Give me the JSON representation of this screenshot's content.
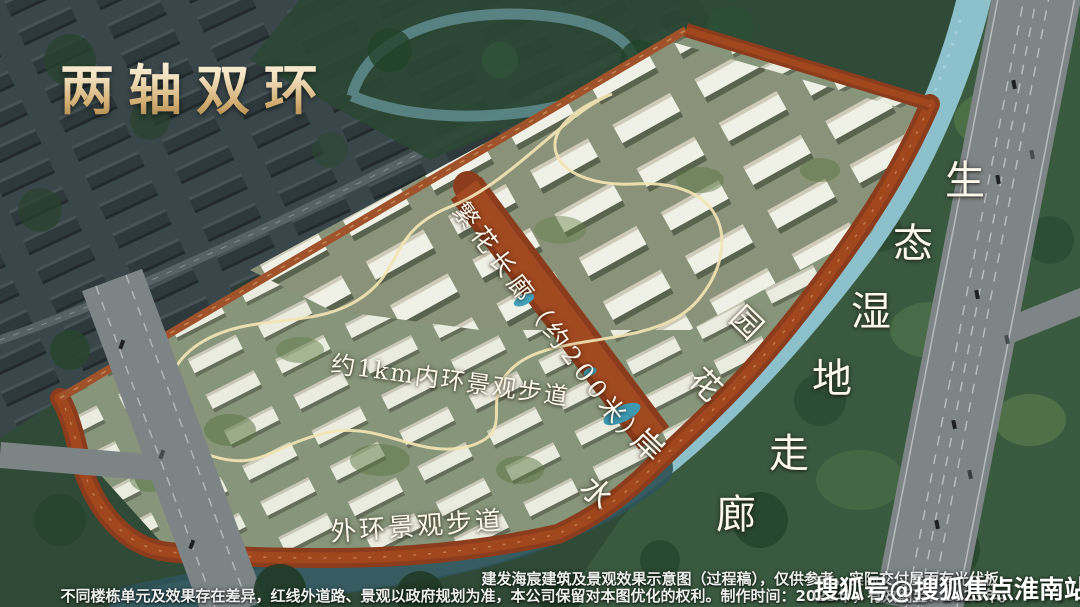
{
  "title": "两轴双环",
  "annotations": {
    "corridor_label": "繁花长廊（约200米）",
    "inner_ring_label": "约1km内环景观步道",
    "outer_ring_label": "外环景观步道",
    "waterfront_label": "水岸花园",
    "waterfront_chars": [
      "水",
      "岸",
      "花",
      "园"
    ],
    "wetland_label": "生态湿地走廊",
    "wetland_chars": [
      "生",
      "态",
      "湿",
      "地",
      "走",
      "廊"
    ]
  },
  "disclaimer": {
    "line1": "建发海宸建筑及景观效果示意图（过程稿），仅供参考，实际交付屋面有光伏板，",
    "line2": "不同楼栋单元及效果存在差异，红线外道路、景观以政府规划为准，本公司保留对本图优化的权利。制作时间：2023年，有效期至：2023年。"
  },
  "watermark": "搜狐号@搜狐焦点淮南站",
  "colors": {
    "title_gold": "#d3ad72",
    "ring_road_rust": "#8a3c1d",
    "river_blue": "#8cc0cb",
    "wetland_green": "#3a5a40",
    "highway_gray": "#7e8587",
    "label_white": "#fdf7ec"
  }
}
